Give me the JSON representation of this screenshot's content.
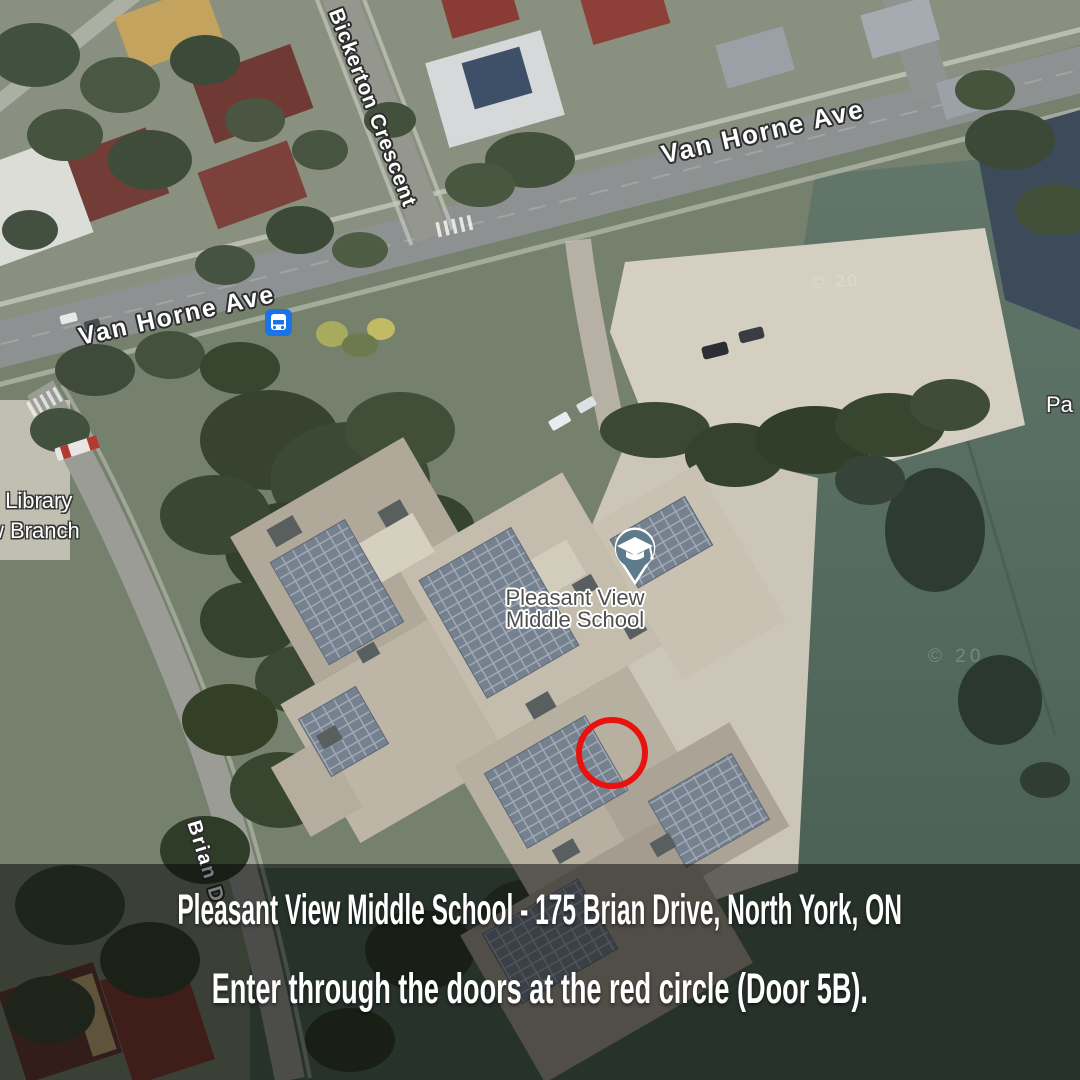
{
  "map": {
    "street_labels": {
      "bickerton": "Bickerton Crescent",
      "van_horne_upper": "Van Horne Ave",
      "van_horne_lower": "Van Horne Ave",
      "brian": "Brian D"
    },
    "poi_labels": {
      "school_line1": "Pleasant View",
      "school_line2": "Middle School",
      "library_line1": "c Library",
      "library_line2": "w Branch",
      "right_edge_partial": "Pa"
    },
    "icons": {
      "school_pin": "graduation-cap-map-pin",
      "bus_stop": "bus-stop-transit-icon"
    },
    "colors": {
      "red_circle": "#e8130f",
      "pin_fill": "#5d7b8b",
      "bus_blue": "#1a73e8",
      "banner_overlay": "rgba(0,0,0,0.52)"
    },
    "watermark": "© 20"
  },
  "banner": {
    "line1": "Pleasant View Middle School - 175 Brian Drive, North York, ON",
    "line2": "Enter through the doors at the red circle (Door 5B)."
  }
}
